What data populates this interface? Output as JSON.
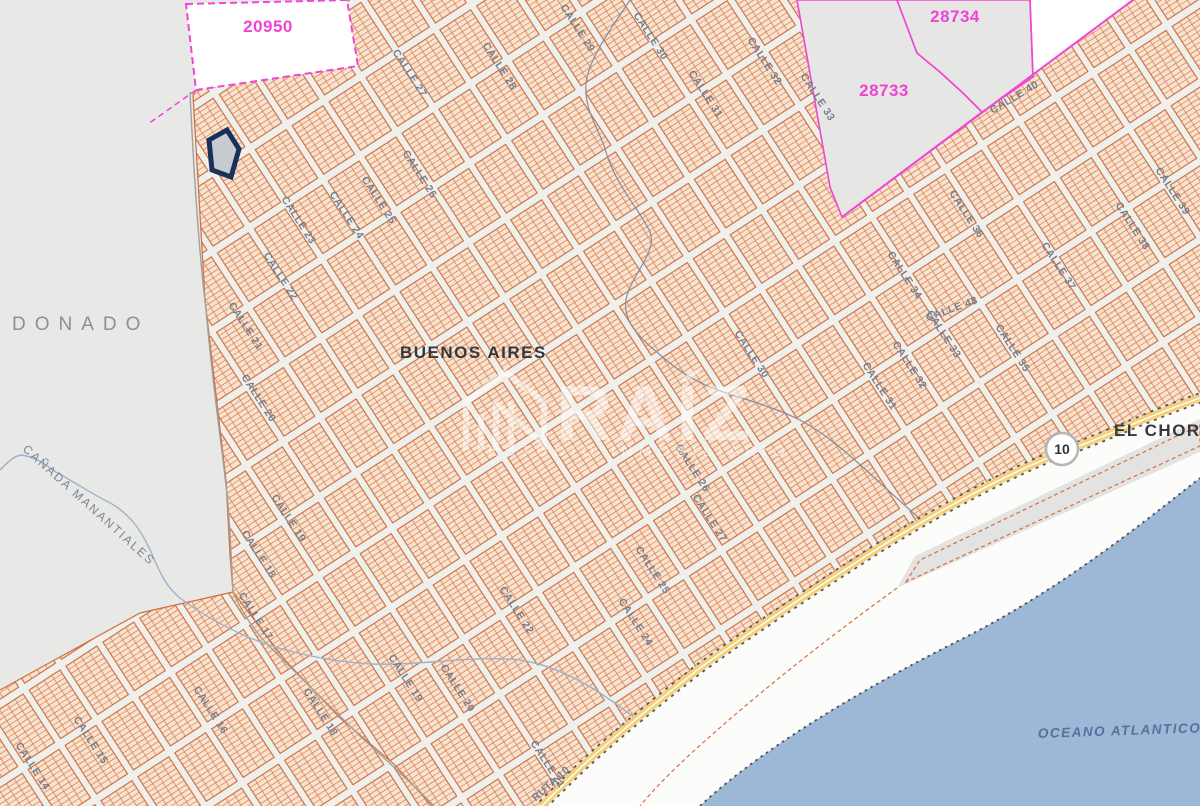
{
  "labels": {
    "maldonado": "DONADO",
    "buenos_aires": "BUENOS AIRES",
    "el_chorro": "EL CHOR",
    "oceano": "OCEANO ATLANTICO",
    "canada": "CAÑADA MANANTIALES",
    "ruta": "RUTA 10"
  },
  "parcels": {
    "p20950": "20950",
    "p28733": "28733",
    "p28734": "28734"
  },
  "route_shield": "10",
  "watermark": {
    "brand": "RAÍZ",
    "tagline": "ESTUDIO INMOBILIARIO"
  },
  "colors": {
    "boundary_magenta": "#ee46d6",
    "lot_hatch_orange": "#cf6f3c",
    "highlight_navy": "#1a3157",
    "water_blue": "#9db8d6",
    "road_yellow": "#f3d07c"
  },
  "streets": [
    {
      "name": "CALLE 23",
      "x": 296,
      "y": 222,
      "rot": 57
    },
    {
      "name": "CALLE 24",
      "x": 344,
      "y": 217,
      "rot": 57
    },
    {
      "name": "CALLE 25",
      "x": 376,
      "y": 202,
      "rot": 57
    },
    {
      "name": "CALLE 26",
      "x": 417,
      "y": 176,
      "rot": 57
    },
    {
      "name": "CALLE 27",
      "x": 407,
      "y": 75,
      "rot": 57
    },
    {
      "name": "CALLE 28",
      "x": 497,
      "y": 68,
      "rot": 57
    },
    {
      "name": "CALLE 29",
      "x": 575,
      "y": 30,
      "rot": 57
    },
    {
      "name": "CALLE 30",
      "x": 648,
      "y": 38,
      "rot": 57
    },
    {
      "name": "CALLE 31",
      "x": 703,
      "y": 96,
      "rot": 57
    },
    {
      "name": "CALLE 32",
      "x": 762,
      "y": 63,
      "rot": 57
    },
    {
      "name": "CALLE 33",
      "x": 815,
      "y": 99,
      "rot": 57
    },
    {
      "name": "CALLE 22",
      "x": 278,
      "y": 278,
      "rot": 57
    },
    {
      "name": "CALLE 21",
      "x": 243,
      "y": 328,
      "rot": 57
    },
    {
      "name": "CALLE 20",
      "x": 256,
      "y": 400,
      "rot": 57
    },
    {
      "name": "CALLE 19",
      "x": 286,
      "y": 520,
      "rot": 57
    },
    {
      "name": "CALLE 18",
      "x": 256,
      "y": 556,
      "rot": 57
    },
    {
      "name": "CALLE 17",
      "x": 253,
      "y": 618,
      "rot": 57
    },
    {
      "name": "CALLE 16",
      "x": 208,
      "y": 712,
      "rot": 57
    },
    {
      "name": "CALLE 15",
      "x": 88,
      "y": 742,
      "rot": 57
    },
    {
      "name": "CALLE 14",
      "x": 30,
      "y": 768,
      "rot": 57
    },
    {
      "name": "CALLE 18",
      "x": 318,
      "y": 714,
      "rot": 57
    },
    {
      "name": "CALLE 19",
      "x": 403,
      "y": 680,
      "rot": 57
    },
    {
      "name": "CALLE 20",
      "x": 455,
      "y": 690,
      "rot": 57
    },
    {
      "name": "CALLE 21",
      "x": 545,
      "y": 766,
      "rot": 57
    },
    {
      "name": "CALLE 22",
      "x": 514,
      "y": 612,
      "rot": 57
    },
    {
      "name": "CALLE 24",
      "x": 633,
      "y": 624,
      "rot": 57
    },
    {
      "name": "CALLE 25",
      "x": 650,
      "y": 572,
      "rot": 57
    },
    {
      "name": "CALLE 26",
      "x": 690,
      "y": 470,
      "rot": 57
    },
    {
      "name": "CALLE 27",
      "x": 707,
      "y": 520,
      "rot": 57
    },
    {
      "name": "CALLE 30",
      "x": 749,
      "y": 356,
      "rot": 57
    },
    {
      "name": "CALLE 31",
      "x": 877,
      "y": 388,
      "rot": 57
    },
    {
      "name": "CALLE 32",
      "x": 907,
      "y": 367,
      "rot": 57
    },
    {
      "name": "CALLE 33",
      "x": 941,
      "y": 336,
      "rot": 57
    },
    {
      "name": "CALLE 34",
      "x": 902,
      "y": 277,
      "rot": 57
    },
    {
      "name": "CALLE 35",
      "x": 1010,
      "y": 350,
      "rot": 57
    },
    {
      "name": "CALLE 36",
      "x": 964,
      "y": 216,
      "rot": 57
    },
    {
      "name": "CALLE 37",
      "x": 1056,
      "y": 268,
      "rot": 57
    },
    {
      "name": "CALLE 38",
      "x": 1130,
      "y": 228,
      "rot": 57
    },
    {
      "name": "CALLE 39",
      "x": 1170,
      "y": 193,
      "rot": 57
    },
    {
      "name": "CALLE 40",
      "x": 1016,
      "y": 100,
      "rot": -31
    },
    {
      "name": "CALLE 48",
      "x": 953,
      "y": 312,
      "rot": -20
    }
  ]
}
